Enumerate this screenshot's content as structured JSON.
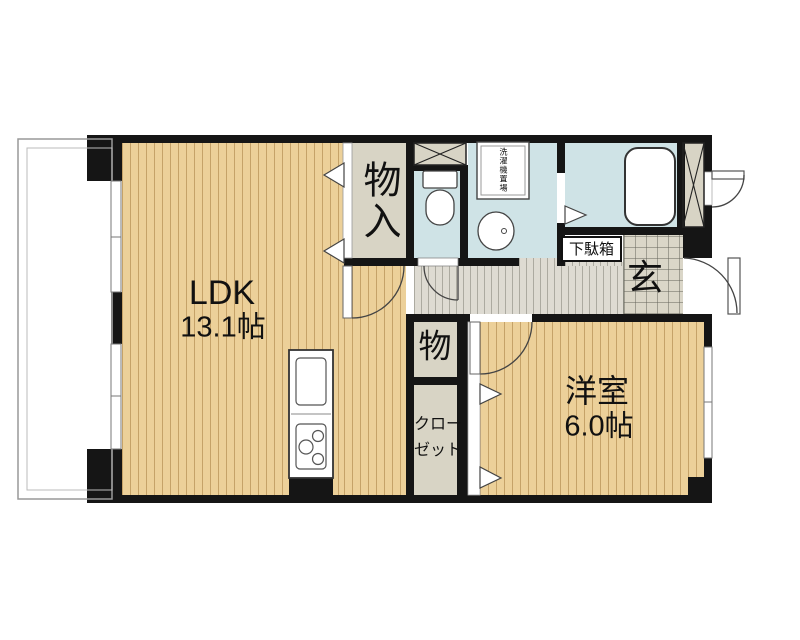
{
  "labels": {
    "ldk": {
      "name": "LDK",
      "size": "13.1帖"
    },
    "western_room": {
      "name": "洋室",
      "size": "6.0帖"
    },
    "storage_closet": "物入",
    "storage_small": "物",
    "closet": {
      "line1": "クロー",
      "line2": "ゼット"
    },
    "entrance": "玄",
    "shoe_cabinet": "下駄箱",
    "laundry": "洗濯機置場"
  },
  "fixtures": [
    "bathtub",
    "toilet",
    "wash-basin",
    "washing-machine-pan",
    "kitchen-sink",
    "kitchen-stove",
    "shoe-cabinet",
    "meter-box",
    "overhead-cabinet"
  ],
  "colors": {
    "wall": "#151515",
    "wood_floor": "#ecd099",
    "storage_floor": "#d8d4c5",
    "wet_area_floor": "#cfe3e6",
    "hallway_floor": "#dedbd2",
    "entrance_tile": "#dad6c8"
  }
}
